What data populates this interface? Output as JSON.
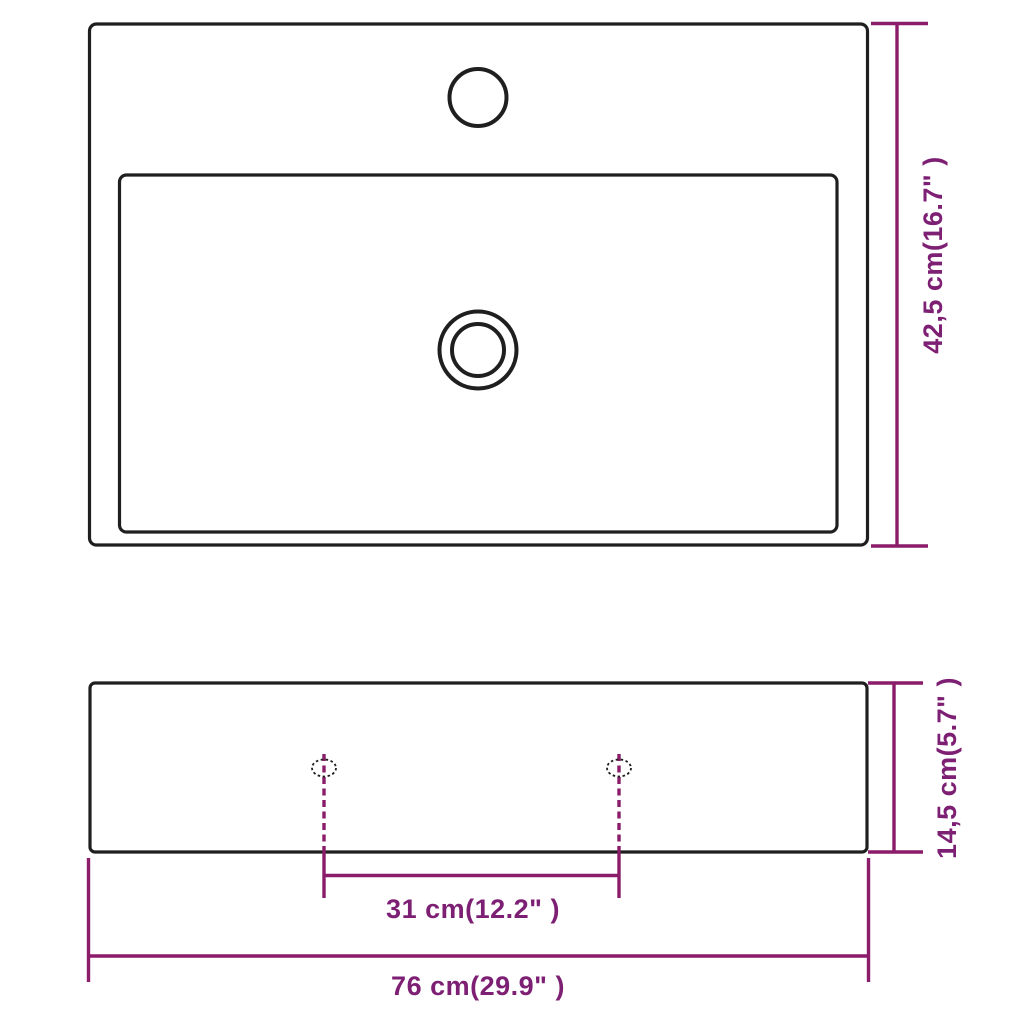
{
  "dimensions": {
    "depth": "42,5 cm(16.7\" )",
    "height": "14,5 cm(5.7\" )",
    "hole_spacing": "31 cm(12.2\" )",
    "width": "76 cm(29.9\" )"
  },
  "colors": {
    "line": "#1f1f1f",
    "dimension": "#8a1c69",
    "text": "#7d2074",
    "background": "#ffffff"
  }
}
